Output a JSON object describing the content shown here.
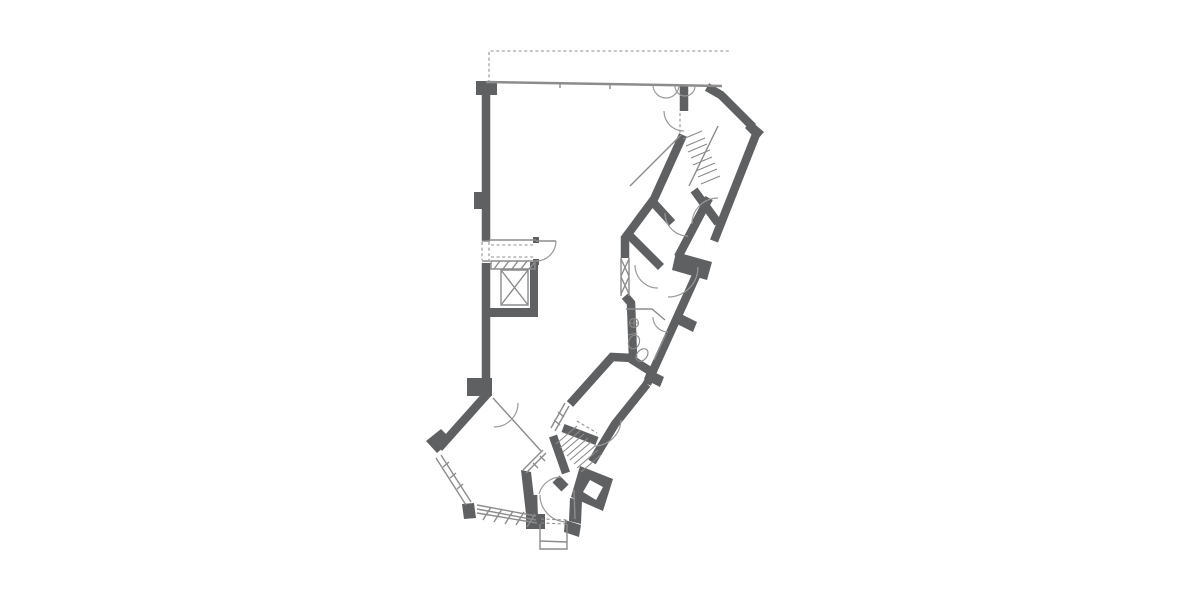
{
  "page": {
    "background": "#ffffff",
    "description": "architectural-floor-plan"
  },
  "plan": {
    "canvas": {
      "width": 1200,
      "height": 600
    },
    "colors": {
      "wall": "#5f6062",
      "thin": "#8c8c8c",
      "arc": "#9a9a9a",
      "tread": "#8a8a8a",
      "dash": "#8f8f8f",
      "hole": "#ffffff"
    },
    "layers": [
      {
        "type": "fill",
        "color": "wall",
        "items": [
          {
            "name": "wall-corner-top-left",
            "points": "476,81 497,81 497,95 476,95"
          },
          {
            "name": "pilaster-upper",
            "points": "474,192 483,192 483,209 474,209"
          },
          {
            "name": "pilaster-lower-block",
            "points": "467,378 492,378 492,396 467,396"
          },
          {
            "name": "corner-pier-lower-left",
            "points": "426,441 441,429 452,440 437,453"
          },
          {
            "name": "window-block-small",
            "points": "462,504 474,503 476,518 464,519"
          },
          {
            "name": "window-end-block",
            "points": "526,514 545,514 545,529 526,529"
          },
          {
            "name": "wall-jog-block-right",
            "points": "676,252 712,262 707,280 672,270"
          },
          {
            "name": "wall-stub-1",
            "points": "681,314 697,322 693,332 677,324"
          },
          {
            "name": "wall-stub-2",
            "points": "648,369 664,377 660,387 644,379"
          },
          {
            "name": "corner-notch-top-right",
            "points": "751,121 764,132 757,140 745,128"
          },
          {
            "name": "stair-corner-block",
            "points": "580,466 613,479 603,511 571,497"
          },
          {
            "name": "wall-below-block",
            "points": "570,498 582,500 581,524 569,521"
          },
          {
            "name": "vestibule-right-chunk",
            "points": "565,520 581,525 579,537 564,532"
          },
          {
            "name": "lobby-left-wall",
            "points": "521,470 531,472 537,523 527,523"
          },
          {
            "name": "door-jamb-top",
            "points": "533,237 539,237 539,243 533,243"
          },
          {
            "name": "door-jamb-bottom",
            "points": "533,259 539,259 539,265 533,265"
          },
          {
            "name": "shaft-right-wall",
            "points": "530,262 538,262 538,316 530,316"
          },
          {
            "name": "shaft-bottom-wall",
            "points": "487,308 538,308 538,317 487,317"
          }
        ]
      },
      {
        "type": "fill",
        "color": "hole",
        "items": [
          {
            "name": "stair-block-square-opening",
            "points": "590,480 603,487 596,500 583,492"
          }
        ]
      },
      {
        "type": "stroke",
        "color": "wall",
        "w": 8.5,
        "items": [
          {
            "name": "left-wall-upper",
            "d": "M 486,84 L 486,241"
          },
          {
            "name": "left-wall-lower",
            "d": "M 486,263 L 486,393"
          },
          {
            "name": "diagonal-wall-lower-left",
            "d": "M 489,392 L 439,448"
          },
          {
            "name": "top-door-stub",
            "d": "M 684,85 L 684,111"
          },
          {
            "name": "top-right-corner-wall",
            "d": "M 707,87 L 721,95 L 753,127"
          },
          {
            "name": "outer-wall-upper-right",
            "d": "M 757,132 L 714,241"
          },
          {
            "name": "outer-wall-mid-right",
            "d": "M 700,267 L 647,384"
          },
          {
            "name": "outer-wall-lower-right",
            "d": "M 647,384 L 615,424 L 592,462"
          },
          {
            "name": "band-left-edge-upper",
            "d": "M 683,135 L 654,199 L 625,238 L 625,258"
          },
          {
            "name": "bathroom-left-wall",
            "d": "M 625,296 L 631,303 L 633,358"
          },
          {
            "name": "bathroom-bottom-elbow",
            "d": "M 633,358 L 612,357 L 570,404"
          },
          {
            "name": "bathroom-bottom-right",
            "d": "M 631,359 L 650,371"
          },
          {
            "name": "stair-room-bottom-wall",
            "d": "M 694,190 L 718,223"
          },
          {
            "name": "inner-wall-right",
            "d": "M 709,198 L 678,257"
          },
          {
            "name": "partition-1",
            "d": "M 650,199 L 672,223"
          },
          {
            "name": "partition-2",
            "d": "M 630,236 L 661,267"
          },
          {
            "name": "stair-left-wall-lower",
            "d": "M 553,436 L 566,473"
          },
          {
            "name": "stair-top-bar",
            "d": "M 563,428 L 597,441"
          },
          {
            "name": "vestibule-left-wall",
            "d": "M 533,495 L 534,526"
          }
        ]
      },
      {
        "type": "stroke",
        "color": "wall",
        "w": 10,
        "items": [
          {
            "name": "lobby-stair-stub",
            "d": "M 556,479 L 565,488"
          }
        ]
      },
      {
        "type": "stroke",
        "color": "thin",
        "w": 2.5,
        "items": [
          {
            "name": "top-facade-wall",
            "d": "M 486,82 L 722,86"
          }
        ]
      },
      {
        "type": "stroke",
        "color": "thin",
        "w": 1.4,
        "items": [
          {
            "name": "lobby-top-wall",
            "d": "M 489,240 L 536,240"
          },
          {
            "name": "elevator-car-outline",
            "d": "M 501,270 L 528,270 L 528,305 L 501,305 Z"
          },
          {
            "name": "elevator-car-cross",
            "d": "M 501,270 L 528,305 M 528,270 L 501,305"
          },
          {
            "name": "elevator-door-band",
            "d": "M 491,261 L 535,261 L 535,269 L 491,269 Z"
          },
          {
            "name": "elevator-door-hatch",
            "d": "M 494,269 L 500,261 M 503,269 L 509,261 M 512,269 L 518,261 M 521,269 L 527,261 M 529,269 L 535,262"
          },
          {
            "name": "interior-thin-wall",
            "d": "M 493,398 L 541,451"
          },
          {
            "name": "lobby-window-diagonal",
            "d": "M 543,450 L 523,470 M 546,453 L 526,473 M 540,456 L 545,461 M 533,463 L 538,468"
          },
          {
            "name": "bathroom-outline",
            "d": "M 626,309 L 652,309 L 665,320 M 666,334 L 654,360"
          },
          {
            "name": "stair-room-edge",
            "d": "M 718,126 L 689,186"
          },
          {
            "name": "understair-line",
            "d": "M 681,135 L 630,186"
          },
          {
            "name": "vestibule-right-line",
            "d": "M 574,490 L 575,519"
          },
          {
            "name": "vestibule-outline",
            "d": "M 540,524 L 540,549 L 567,549 L 567,524"
          },
          {
            "name": "vestibule-inner-line",
            "d": "M 540,541 L 567,542"
          },
          {
            "name": "window-band-bottom",
            "d": "M 477,505 L 536,516 M 477,509 L 536,520 M 477,513 L 537,523"
          },
          {
            "name": "window-band-hatch",
            "d": "M 483,520 L 491,507 M 494,522 L 502,509 M 505,524 L 513,511 M 516,525 L 524,512 M 527,527 L 535,514"
          },
          {
            "name": "window-lower-left",
            "d": "M 436,458 L 466,505 M 441,455 L 471,502 M 443,467 L 449,462 M 450,478 L 456,473 M 457,489 L 463,484"
          },
          {
            "name": "window-mid-left-frame",
            "d": "M 621,258 L 621,296 M 629,258 L 629,296"
          },
          {
            "name": "window-mid-left-cross",
            "d": "M 621,259 L 629,276 M 629,259 L 621,276 M 621,277 L 629,294 M 629,277 L 621,294"
          },
          {
            "name": "window-corridor",
            "d": "M 569,406 L 555,431 M 565,403 L 551,428 M 558,412 L 564,417 M 554,420 L 560,425"
          },
          {
            "name": "wall-opening-frame",
            "d": "M 482,241 L 490,241 M 482,261 L 490,261"
          },
          {
            "name": "elevator-door-leaf",
            "d": "M 536,241 L 556,241"
          },
          {
            "name": "top-wall-ticks",
            "d": "M 560,84 L 560,88 M 610,85 L 610,89"
          }
        ]
      },
      {
        "type": "stroke",
        "color": "arc",
        "w": 1.2,
        "items": [
          {
            "name": "door-arc-top-1",
            "d": "M 653,85 A 13 13 0 0 0 679,85"
          },
          {
            "name": "door-arc-top-2",
            "d": "M 675,86 A 10 10 0 0 0 695,86"
          },
          {
            "name": "door-arc-stair-entry",
            "d": "M 664,111 A 20 20 0 0 0 684,131"
          },
          {
            "name": "door-arc-stair-room",
            "d": "M 692,224 A 26 26 0 0 1 718,198"
          },
          {
            "name": "door-arc-room-1",
            "d": "M 665,213 A 23 23 0 0 0 688,236"
          },
          {
            "name": "door-arc-room-2",
            "d": "M 698,267 A 30 30 0 0 1 668,297"
          },
          {
            "name": "door-arc-room-3",
            "d": "M 635,265 A 23 23 0 0 0 658,288"
          },
          {
            "name": "door-arc-bathroom",
            "d": "M 653,317 A 15 15 0 0 0 668,332"
          },
          {
            "name": "door-arc-elevator-lobby",
            "d": "M 556,241 A 20 20 0 0 1 536,261"
          },
          {
            "name": "door-arc-lower-left-room",
            "d": "M 518,403 A 24 24 0 0 1 494,427"
          },
          {
            "name": "door-arc-corridor",
            "d": "M 621,420 A 27 27 0 0 1 594,446"
          },
          {
            "name": "door-arc-vestibule-main",
            "d": "M 540,495 A 27 27 0 0 0 567,522"
          },
          {
            "name": "door-arc-vestibule-small",
            "d": "M 539,494 A 23 23 0 0 1 561,477"
          }
        ]
      },
      {
        "type": "stroke",
        "color": "tread",
        "w": 1.1,
        "items": [
          {
            "name": "stair-treads-upper",
            "d": "M 683,139 L 702,131 M 686,146 L 705,138 M 688,152 L 707,144 M 691,158 L 710,150 M 693,165 L 712,157 M 696,171 L 715,163 M 698,177 L 717,169 M 701,184 L 720,176"
          },
          {
            "name": "stair-treads-lower",
            "d": "M 556,444 L 577,426 M 560,448 L 581,430 M 563,452 L 584,434 M 567,456 L 588,438 M 570,460 L 591,442 M 574,464 L 595,446 M 577,468 L 598,450 M 581,472 L 602,454"
          }
        ]
      },
      {
        "type": "stroke",
        "color": "thin",
        "w": 1.1,
        "items": [
          {
            "name": "fixture-sink",
            "d": "M 629.5,323 A 4.5 4.5 0 1 0 638.5,323 A 4.5 4.5 0 1 0 629.5,323 M 634,318.5 L 634,327.5 M 629.5,323 L 638.5,323"
          },
          {
            "name": "fixture-toilet",
            "d": "M 629,340 A 5 6.5 20 1 1 639,344 A 5 6.5 20 1 1 629,340 M 628,335 L 637,333"
          },
          {
            "name": "fixture-bidet",
            "d": "M 638,352 A 3.5 5 40 1 1 646,358 A 3.5 5 40 1 1 638,352"
          }
        ]
      },
      {
        "type": "stroke",
        "color": "dash",
        "w": 1.1,
        "dash": "3,2.6",
        "items": [
          {
            "name": "projection-dashed-line",
            "d": "M 489,83 L 489,51 L 729,51"
          },
          {
            "name": "dashed-opening-top-stub",
            "d": "M 680,113 L 680,133"
          },
          {
            "name": "dashed-elevator-lobby",
            "d": "M 491,245 L 535,245 M 491,257 L 535,257"
          },
          {
            "name": "dashed-wall-opening",
            "d": "M 482,242 L 482,260 M 489,242 L 489,260"
          },
          {
            "name": "dashed-vestibule-top",
            "d": "M 541,519 L 567,520 M 541,523 L 567,524"
          },
          {
            "name": "dashed-corridor-mark",
            "d": "M 577,421 L 597,433"
          }
        ]
      }
    ]
  }
}
